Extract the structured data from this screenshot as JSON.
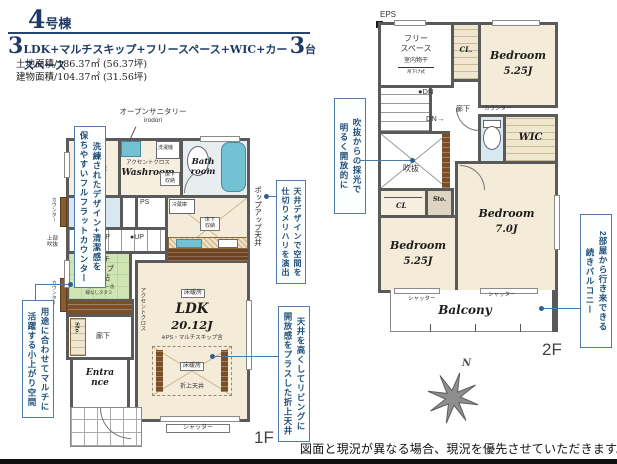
{
  "colors": {
    "accent_navy": "#1f3a66",
    "callout_blue": "#1f4e79",
    "wall_gray": "#5a5a5a",
    "room_cream": "#f4ebd8",
    "tatami_green": "#cfe5b4",
    "bath_blue": "#72c2d4",
    "wood_brown": "#7a4f28"
  },
  "header": {
    "num_big": "4",
    "num_small": "号棟",
    "plan_big1": "3",
    "plan_mid": "LDK+マルチスキップ+フリースペース+WIC+カースペース",
    "plan_big2": "3",
    "plan_tail": "台",
    "land": "土地面積/186.37㎡ (56.37坪)",
    "bldg": "建物面積/104.37㎡ (31.56坪)"
  },
  "callouts": {
    "counter_l1": "洗練されたデザイン+清潔感を",
    "counter_l2": "保ちやすいフルフラットカウンター",
    "ceiling_l1": "天井デザインで空間を",
    "ceiling_l2": "仕切りメリハリを演出",
    "multi_l1": "用途に合わせてマルチに",
    "multi_l2": "活躍する小上がり空間",
    "oriage_l1": "天井を高くしてリビングに",
    "oriage_l2": "開放感をプラスした折上天井",
    "void_l1": "吹抜からの採光で",
    "void_l2": "明るく開放的に",
    "balcony_l1": "2部屋から行き来できる",
    "balcony_l2": "続きバルコニー"
  },
  "f1": {
    "open_sanitary": "オープンサニタリー",
    "irodori": "irodori",
    "sto": "Sto.",
    "shelf": "可動棚4段",
    "accent1": "アクセントクロス",
    "washroom": "Washroom",
    "washer": "洗濯機",
    "bath": "Bath room",
    "underfloor1": "床下収納",
    "counter1": "カウンター",
    "counter2": "カウンター",
    "ps": "PS",
    "fridge": "冷蔵庫",
    "underfloor2": "床下収納",
    "popup": "ポップアップ天井",
    "up1": "●UP",
    "up2": "●UP",
    "upper_void": "上部吹抜",
    "multi1": "マルチ",
    "multi2": "スキップ",
    "multi3": "3.12帖",
    "multi_note1": "※カウンター含",
    "multi_note2": "縁なしタタミ",
    "sto2": "Sto.",
    "hall": "廊下",
    "entrance": "Entrance",
    "accent2": "アクセントクロス",
    "heat1": "床暖房",
    "heat2": "床暖房",
    "ldk": "LDK",
    "ldk_size": "20.12J",
    "ldk_note": "※PS・マルチスキップ含",
    "oriage": "折上天井",
    "shutter": "シャッター",
    "floor": "1F"
  },
  "f2": {
    "eps": "EPS",
    "free1": "フリー",
    "free2": "スペース",
    "drying": "室内物干",
    "drying_sub": "吊下げ式",
    "cl1": "CL.",
    "bed1": "Bedroom",
    "bed1_size": "5.25J",
    "dn1": "●DN",
    "dn2": "DN→",
    "hall": "廊下",
    "counter": "カウンター",
    "wic": "WIC",
    "void": "吹抜",
    "cl2": "CL",
    "sto": "Sto.",
    "bed2": "Bedroom",
    "bed2_size": "5.25J",
    "bed3": "Bedroom",
    "bed3_size": "7.0J",
    "shutter1": "シャッター",
    "shutter2": "シャッター",
    "balcony": "Balcony",
    "floor": "2F",
    "north": "N"
  },
  "footer": {
    "disclaimer": "図面と現況が異なる場合、現況を優先させていただきます。"
  }
}
